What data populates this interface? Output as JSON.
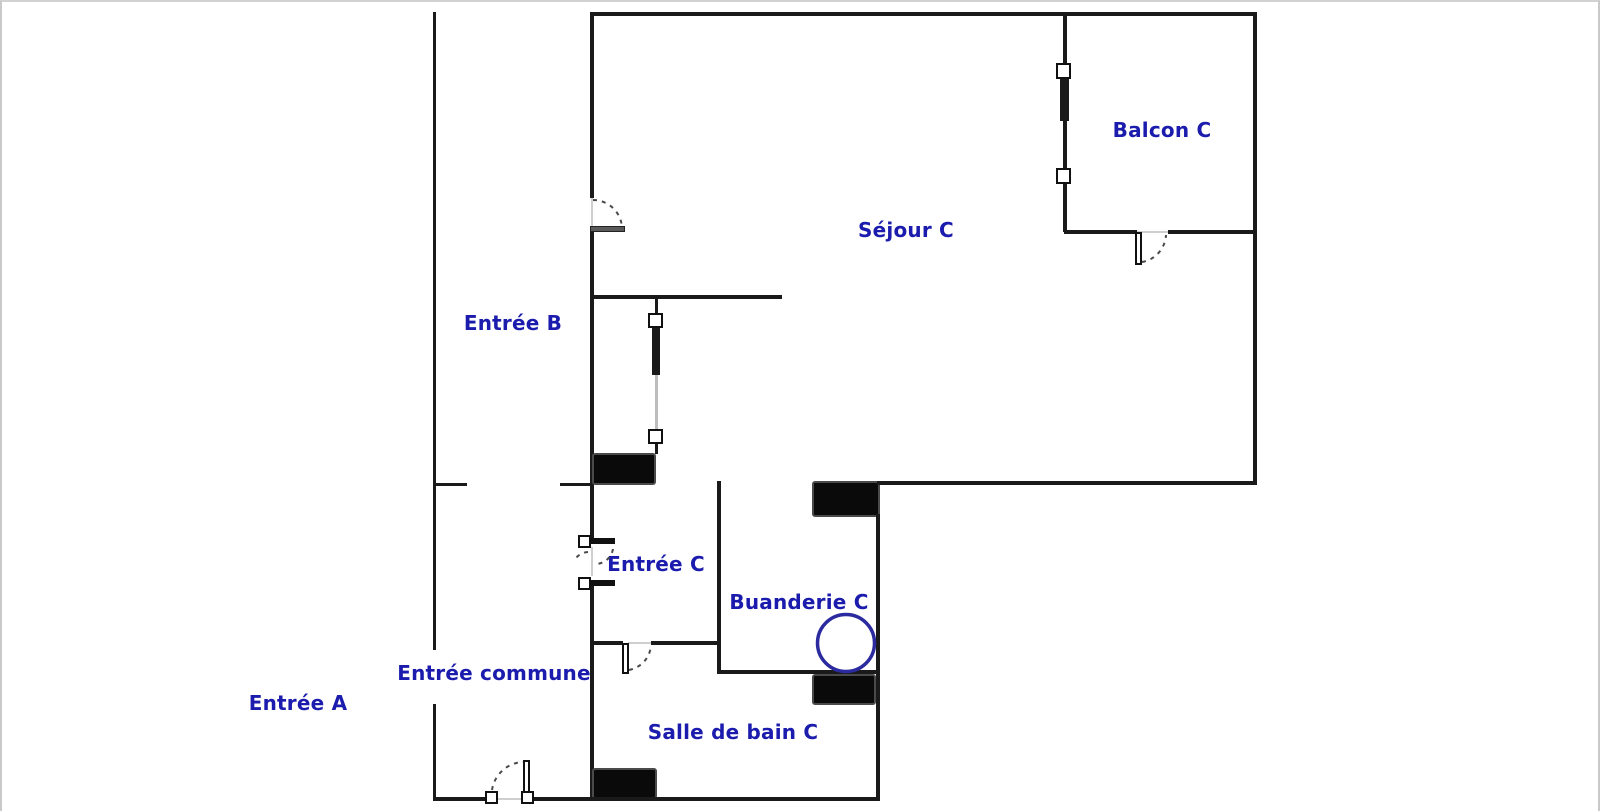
{
  "floorplan": {
    "rooms": [
      {
        "id": "entree-a",
        "label": "Entrée A"
      },
      {
        "id": "entree-commune",
        "label": "Entrée commune"
      },
      {
        "id": "entree-b",
        "label": "Entrée B"
      },
      {
        "id": "entree-c",
        "label": "Entrée C"
      },
      {
        "id": "sejour-c",
        "label": "Séjour C"
      },
      {
        "id": "balcon-c",
        "label": "Balcon C"
      },
      {
        "id": "buanderie-c",
        "label": "Buanderie C"
      },
      {
        "id": "salle-de-bain-c",
        "label": "Salle de bain C"
      }
    ],
    "colors": {
      "wall": "#1a1a1a",
      "label_text": "#1b1bad",
      "washing_machine_stroke": "#2b2b9f",
      "background": "#ffffff"
    },
    "symbols": {
      "washing-machine-icon": "circle outline",
      "door-swing-icon": "dashed quarter arc with leaf",
      "window-icon": "wall line with small square end markers",
      "load-bearing-wall": "solid black rectangle"
    }
  }
}
